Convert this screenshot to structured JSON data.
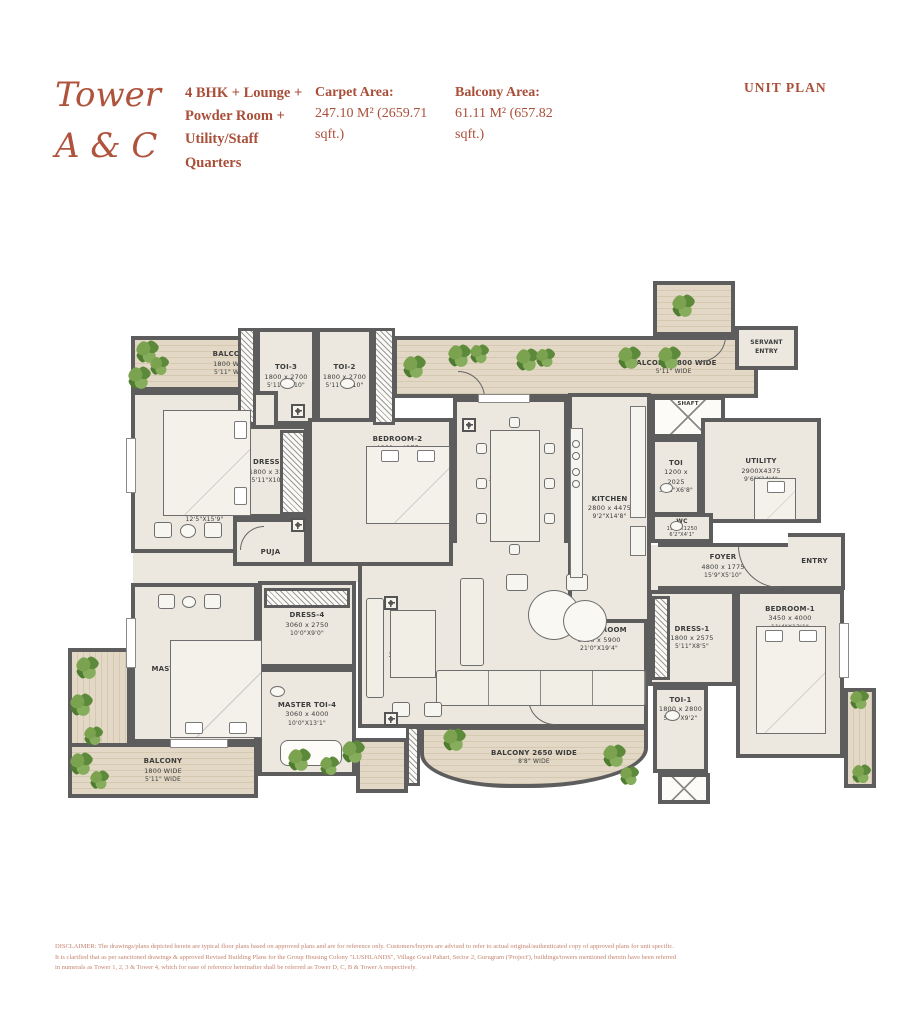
{
  "header": {
    "tower_line1": "Tower",
    "tower_line2": "A & C",
    "unit_type": "4 BHK + Lounge + Powder Room + Utility/Staff Quarters",
    "carpet_area_label": "Carpet Area:",
    "carpet_area_value": "247.10 M² (2659.71 sqft.)",
    "balcony_area_label": "Balcony Area:",
    "balcony_area_value": "61.11 M² (657.82 sqft.)",
    "unit_plan_label": "UNIT PLAN",
    "accent_color": "#a94e38"
  },
  "rooms": {
    "balcony_tl": {
      "name": "BALCONY",
      "mm": "1800 WIDE",
      "ft": "5'11\" WIDE"
    },
    "bedroom3": {
      "name": "BEDROOM-3",
      "mm": "3800 x 4800",
      "ft": "12'5\"X15'9\""
    },
    "toi3": {
      "name": "TOI-3",
      "mm": "1800 x 2700",
      "ft": "5'11\"X8'10\""
    },
    "toi2": {
      "name": "TOI-2",
      "mm": "1800 x 2700",
      "ft": "5'11\"X8'10\""
    },
    "bedroom2": {
      "name": "BEDROOM-2",
      "mm": "4660 x 4375",
      "ft": "15'3\"X14'4\""
    },
    "dress3": {
      "name": "DRESS-3",
      "mm": "1800 x 3250",
      "ft": "5'11\"X10'8\""
    },
    "puja": {
      "name": "PUJA"
    },
    "dining": {
      "name": "DINING",
      "mm": "3500 x 4575",
      "ft": "11'6\"X15'0\""
    },
    "balcony_tr": {
      "name": "BALCONY 1800 WIDE",
      "ft": "5'11\" WIDE"
    },
    "kitchen": {
      "name": "KITCHEN",
      "mm": "2800 x 4475",
      "ft": "9'2\"X14'8\""
    },
    "shaft_top": {
      "name": "SHAFT"
    },
    "toi_servant": {
      "name": "TOI",
      "mm": "1200 x 2025",
      "ft": "3'11\"X6'8\""
    },
    "utility": {
      "name": "UTILITY",
      "mm": "2900X4375",
      "ft": "9'6\"X14'4\""
    },
    "servant_entry": {
      "name": "SERVANT ENTRY"
    },
    "wc": {
      "name": "WC",
      "mm": "1900X1250",
      "ft": "6'2\"X4'1\""
    },
    "foyer": {
      "name": "FOYER",
      "mm": "4800 x 1775",
      "ft": "15'9\"X5'10\""
    },
    "entry": {
      "name": "ENTRY"
    },
    "living": {
      "name": "LIVING ROOM",
      "mm": "6400 x 5900",
      "ft": "21'0\"X19'4\""
    },
    "lounge": {
      "name": "LOUNGE",
      "mm": "3400 x 5900",
      "ft": "11'2\"X19'4\""
    },
    "master_bedroom4": {
      "name": "MASTER BEDROOM-4",
      "mm": "3800 x 5050",
      "ft": "12'5\"X16'7\""
    },
    "dress4": {
      "name": "DRESS-4",
      "mm": "3060 x 2750",
      "ft": "10'0\"X9'0\""
    },
    "master_toi4": {
      "name": "MASTER TOI-4",
      "mm": "3060 x 4000",
      "ft": "10'0\"X13'1\""
    },
    "balcony_bl": {
      "name": "BALCONY",
      "mm": "1800 WIDE",
      "ft": "5'11\" WIDE"
    },
    "balcony_bc": {
      "name": "BALCONY 2650 WIDE",
      "ft": "8'8\" WIDE"
    },
    "dress1": {
      "name": "DRESS-1",
      "mm": "1800 x 2575",
      "ft": "5'11\"X8'5\""
    },
    "bedroom1": {
      "name": "BEDROOM-1",
      "mm": "3450 x 4000",
      "ft": "11'4\"X13'1\""
    },
    "toi1": {
      "name": "TOI-1",
      "mm": "1800 x 2800",
      "ft": "5'11\"X9'2\""
    }
  },
  "disclaimer": {
    "line1": "DISCLAIMER: The drawings/plans depicted herein are typical floor plans based on approved plans and are for reference only. Customers/buyers are advised to refer to actual original/authenticated copy of approved plans for unit specific.",
    "line2": "It is clarified that as per sanctioned drawings & approved Revised Building Plans for the Group Housing Colony \"LUSHLANDS\", Village Gwal Pahari, Sector 2, Gurugram ('Project'), buildings/towers mentioned therein have been referred",
    "line3": "in numerals as Tower 1, 2, 3 & Tower 4, which for ease of reference hereinafter shall be referred as Tower D, C, B & Tower A respectively."
  }
}
